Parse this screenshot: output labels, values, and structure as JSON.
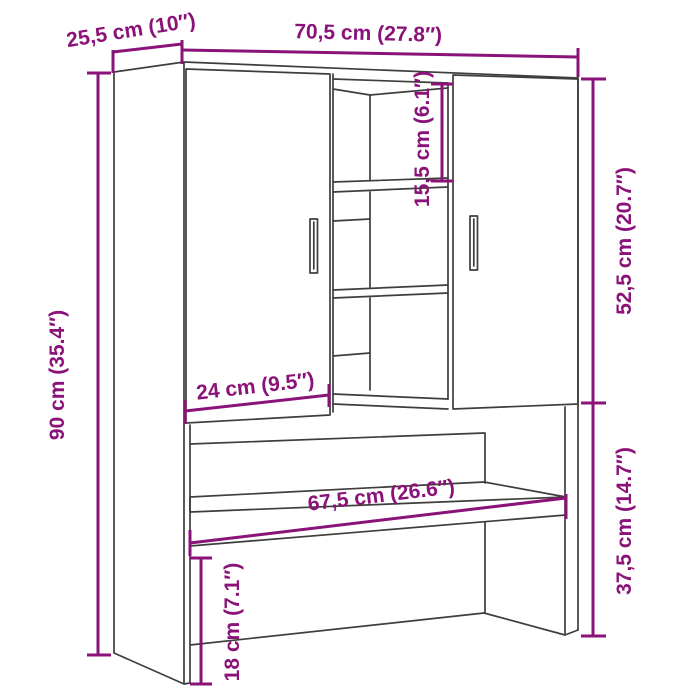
{
  "page": {
    "type": "product dimension diagram",
    "subject": "over-washing-machine cabinet with two doors, middle open shelves and lower niche shelf",
    "background": "#ffffff"
  },
  "style": {
    "annotation_color": "#8A1278",
    "outline_color": "#3E3E3C"
  },
  "annotations": {
    "total_width": {
      "label": "70,5 cm (27.8″)",
      "cm": 70.5,
      "inches": 27.8
    },
    "depth": {
      "label": "25,5 cm (10″)",
      "cm": 25.5,
      "inches": 10
    },
    "total_height": {
      "label": "90 cm (35.4″)",
      "cm": 90,
      "inches": 35.4
    },
    "top_compartment_height": {
      "label": "15,5 cm (6.1″)",
      "cm": 15.5,
      "inches": 6.1
    },
    "upper_section_height": {
      "label": "52,5 cm (20.7″)",
      "cm": 52.5,
      "inches": 20.7
    },
    "door_width": {
      "label": "24 cm (9.5″)",
      "cm": 24,
      "inches": 9.5
    },
    "niche_width": {
      "label": "67,5 cm (26.6″)",
      "cm": 67.5,
      "inches": 26.6
    },
    "lower_section_height": {
      "label": "37,5 cm (14.7″)",
      "cm": 37.5,
      "inches": 14.7
    },
    "side_drop_height": {
      "label": "18 cm (7.1″)",
      "cm": 18,
      "inches": 7.1
    }
  }
}
